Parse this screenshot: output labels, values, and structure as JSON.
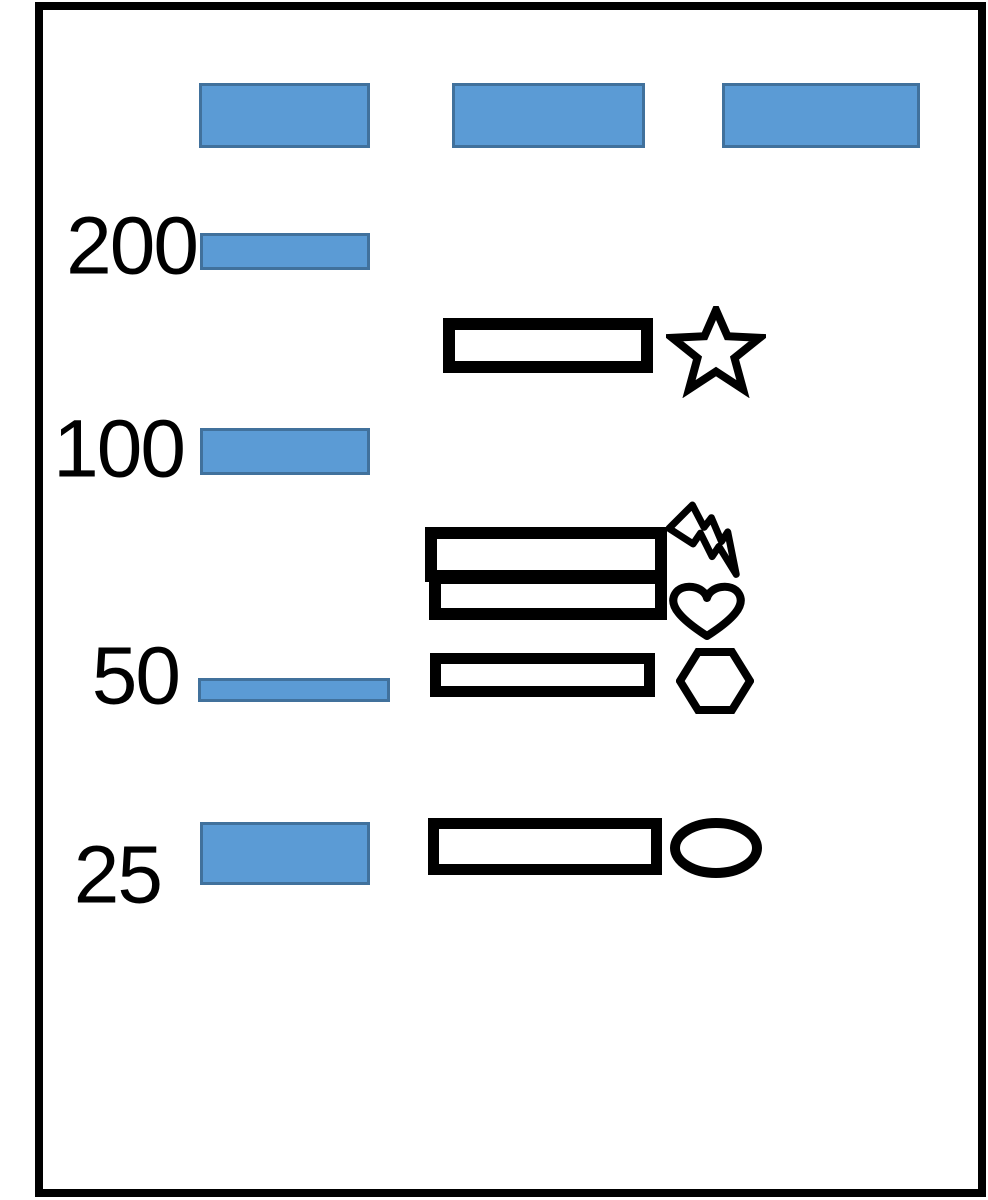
{
  "diagram": {
    "title": "gel-electrophoresis-schematic",
    "background": "#ffffff",
    "colors": {
      "band_fill": "#5b9bd5",
      "band_stroke": "#41719c",
      "outline": "#000000"
    },
    "frame": {
      "x": 35,
      "y": 2,
      "w": 951,
      "h": 1195
    },
    "wells": [
      {
        "lane": 1,
        "x": 199,
        "y": 83,
        "w": 171,
        "h": 65
      },
      {
        "lane": 2,
        "x": 452,
        "y": 83,
        "w": 193,
        "h": 65
      },
      {
        "lane": 3,
        "x": 722,
        "y": 83,
        "w": 198,
        "h": 65
      }
    ],
    "ladder": {
      "rows": [
        {
          "label": "200",
          "label_right": 197,
          "label_center_y": 248,
          "band": {
            "x": 200,
            "y": 233,
            "w": 170,
            "h": 37
          }
        },
        {
          "label": "100",
          "label_right": 184,
          "label_center_y": 451,
          "band": {
            "x": 200,
            "y": 428,
            "w": 170,
            "h": 47
          }
        },
        {
          "label": "50",
          "label_right": 179,
          "label_center_y": 678,
          "band": {
            "x": 198,
            "y": 678,
            "w": 192,
            "h": 24
          }
        },
        {
          "label": "25",
          "label_right": 161,
          "label_center_y": 877,
          "band": {
            "x": 200,
            "y": 822,
            "w": 170,
            "h": 63
          }
        }
      ]
    },
    "sample_bands": [
      {
        "id": "band-1",
        "x": 443,
        "y": 318,
        "w": 210,
        "h": 55,
        "stroke_w": 12,
        "symbol": "star"
      },
      {
        "id": "band-2",
        "x": 425,
        "y": 527,
        "w": 242,
        "h": 55,
        "stroke_w": 12,
        "symbol": "lightning-bolt"
      },
      {
        "id": "band-3",
        "x": 429,
        "y": 572,
        "w": 238,
        "h": 48,
        "stroke_w": 12,
        "symbol": "heart"
      },
      {
        "id": "band-4",
        "x": 430,
        "y": 653,
        "w": 225,
        "h": 44,
        "stroke_w": 11,
        "symbol": "hexagon"
      },
      {
        "id": "band-5",
        "x": 428,
        "y": 818,
        "w": 234,
        "h": 57,
        "stroke_w": 11,
        "symbol": "ellipse"
      }
    ],
    "symbols": [
      {
        "name": "star",
        "x": 666,
        "y": 306,
        "w": 100,
        "h": 92
      },
      {
        "name": "lightning-bolt",
        "x": 662,
        "y": 498,
        "w": 94,
        "h": 94
      },
      {
        "name": "heart",
        "x": 668,
        "y": 582,
        "w": 78,
        "h": 60
      },
      {
        "name": "hexagon",
        "x": 676,
        "y": 646,
        "w": 78,
        "h": 70
      },
      {
        "name": "ellipse",
        "x": 668,
        "y": 816,
        "w": 96,
        "h": 64
      }
    ]
  }
}
